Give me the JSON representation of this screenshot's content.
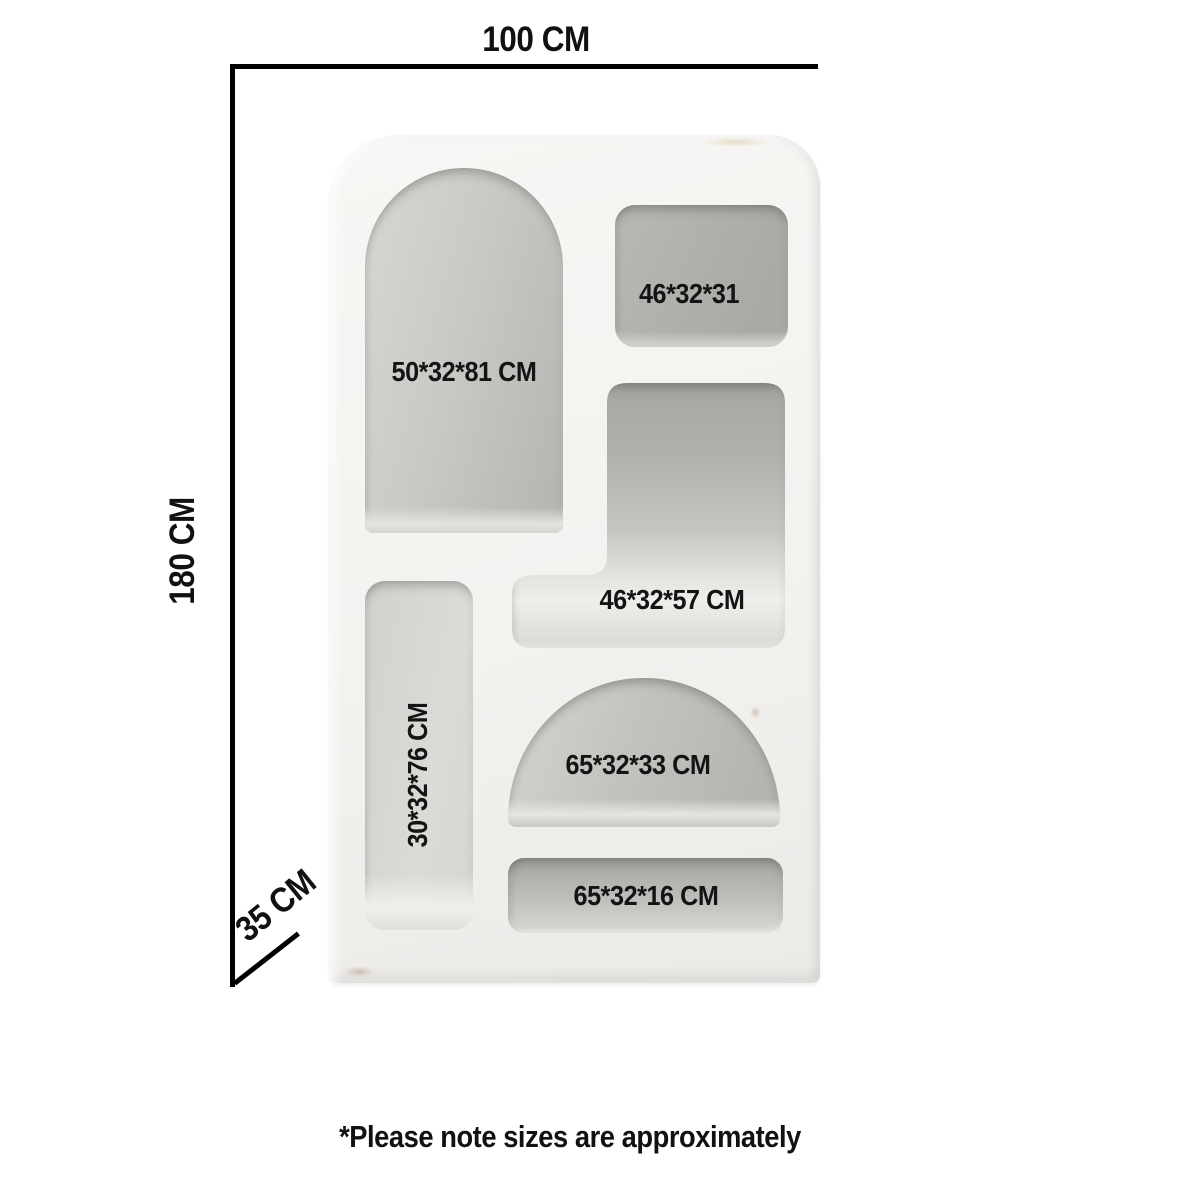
{
  "overall_dimensions": {
    "width": "100 CM",
    "height": "180 CM",
    "depth": "35 CM"
  },
  "compartments": [
    {
      "id": "tall-arch-niche",
      "label": "50*32*81 CM"
    },
    {
      "id": "top-right-niche",
      "label": "46*32*31"
    },
    {
      "id": "middle-right-niche",
      "label": "46*32*57 CM"
    },
    {
      "id": "left-column-niche",
      "label": "30*32*76 CM"
    },
    {
      "id": "bottom-arch-niche",
      "label": "65*32*33 CM"
    },
    {
      "id": "bottom-strip-niche",
      "label": "65*32*16 CM"
    }
  ],
  "footer": {
    "note": "*Please note sizes are approximately"
  },
  "colors": {
    "background": "#ffffff",
    "dimension_line": "#000000",
    "label_text": "#141414",
    "shelf_face": "#f2f1ee",
    "niche_interior": "#b9b7b4"
  }
}
